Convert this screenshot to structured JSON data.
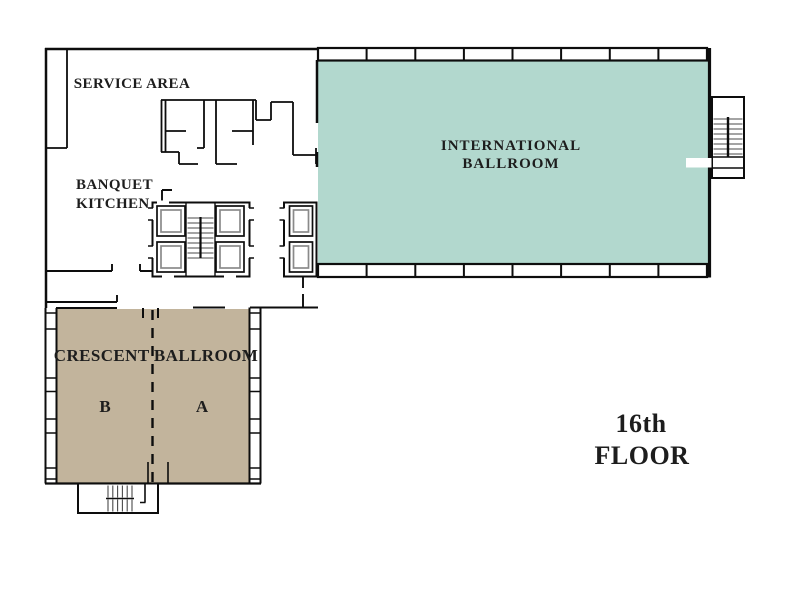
{
  "floor_label": {
    "line1": "16th",
    "line2": "FLOOR"
  },
  "rooms": {
    "international_ballroom": {
      "label_line1": "INTERNATIONAL",
      "label_line2": "BALLROOM",
      "fill": "#b2d8ce"
    },
    "crescent_ballroom": {
      "label": "CRESCENT BALLROOM",
      "section_left": "B",
      "section_right": "A",
      "fill": "#c2b49c"
    },
    "service_area": {
      "label": "SERVICE AREA"
    },
    "banquet_kitchen": {
      "label_line1": "BANQUET",
      "label_line2": "KITCHEN"
    }
  },
  "colors": {
    "walls": "#0d0d0d",
    "text": "#1d1d1d",
    "stair_treads": "#4a4a4a",
    "elevator_inner": "#8a8a8a"
  }
}
